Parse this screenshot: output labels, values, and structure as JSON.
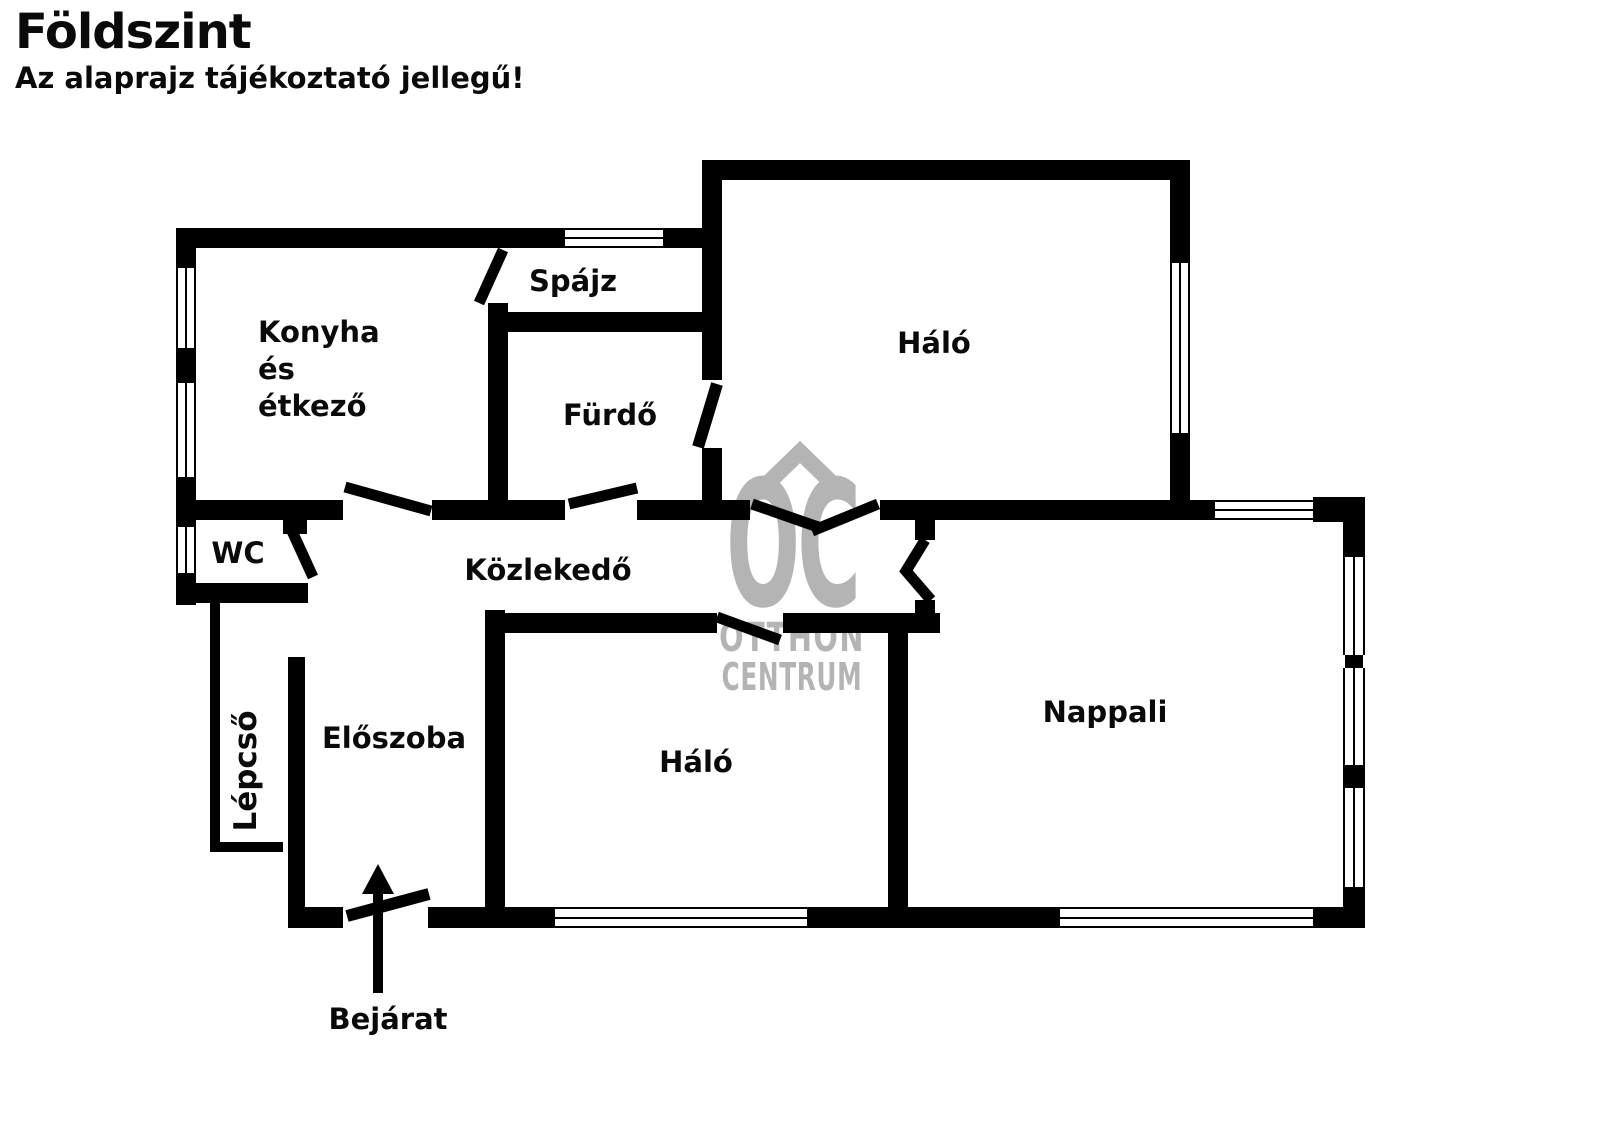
{
  "header": {
    "title": "Földszint",
    "subtitle": "Az alaprajz tájékoztató jellegű!"
  },
  "rooms": {
    "konyha": {
      "line1": "Konyha",
      "line2": "és",
      "line3": "étkező"
    },
    "spajz": "Spájz",
    "furdo": "Fürdő",
    "halo_top": "Háló",
    "wc": "WC",
    "kozlekedo": "Közlekedő",
    "lepcso": "Lépcső",
    "eloszoba": "Előszoba",
    "halo_middle": "Háló",
    "nappali": "Nappali"
  },
  "entrance": {
    "label": "Bejárat"
  },
  "watermark": {
    "monogram": "OC",
    "name_line1": "OTTHON",
    "name_line2": "CENTRUM"
  },
  "colors": {
    "wall": "#000000",
    "background": "#ffffff",
    "watermark": "#b4b4b4"
  },
  "icons": {
    "entrance_arrow": "up-arrow",
    "chevron": "roof-chevron"
  }
}
